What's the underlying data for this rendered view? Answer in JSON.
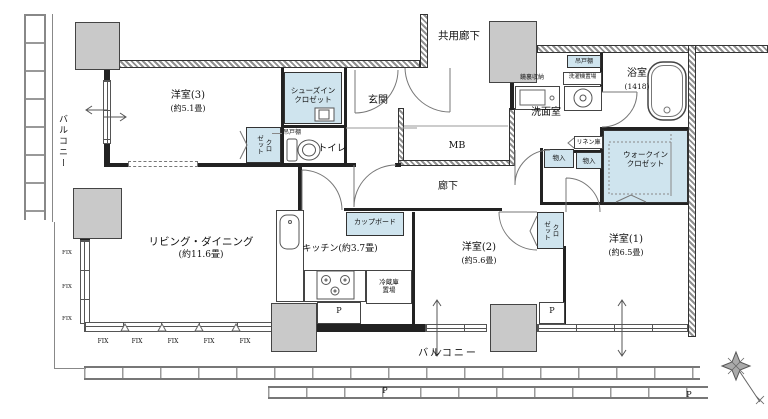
{
  "plan": {
    "balcony_left": "バルコニー",
    "balcony_bottom": "バルコニー",
    "shared_corridor": "共用廊下",
    "corridor": "廊下",
    "entrance": "玄関",
    "mb": "MB",
    "toilet": "トイレ",
    "hanging_cabinet_toilet": "吊戸棚",
    "hanging_cabinet_laundry": "吊戸棚",
    "washer_space": "洗濯機置場",
    "mirror_storage": "鏡裏収納",
    "washroom": "洗面室",
    "bath_name": "浴室",
    "bath_size": "(1418)",
    "linen": "リネン庫",
    "storage_1": "物入",
    "storage_2": "物入",
    "wic": "ウォークイン\nクロゼット",
    "shoes_closet": "シューズイン\nクロゼット",
    "closet_col_left": "ゼット",
    "closet_col_right": "クロ",
    "cupboard": "カップボード",
    "fridge_space": "冷蔵庫\n置場",
    "kitchen": "キッチン(約3.7畳)",
    "living_name": "リビング・ダイニング",
    "living_size": "(約11.6畳)",
    "western1_name": "洋室(1)",
    "western1_size": "(約6.5畳)",
    "western2_name": "洋室(2)",
    "western2_size": "(約5.6畳)",
    "western3_name": "洋室(3)",
    "western3_size": "(約5.1畳)",
    "fix": "FIX",
    "p": "P"
  },
  "colors": {
    "storage_fill": "#cfe4ee",
    "pillar_fill": "#c9c9c9",
    "wall": "#222222",
    "line": "#666666"
  }
}
